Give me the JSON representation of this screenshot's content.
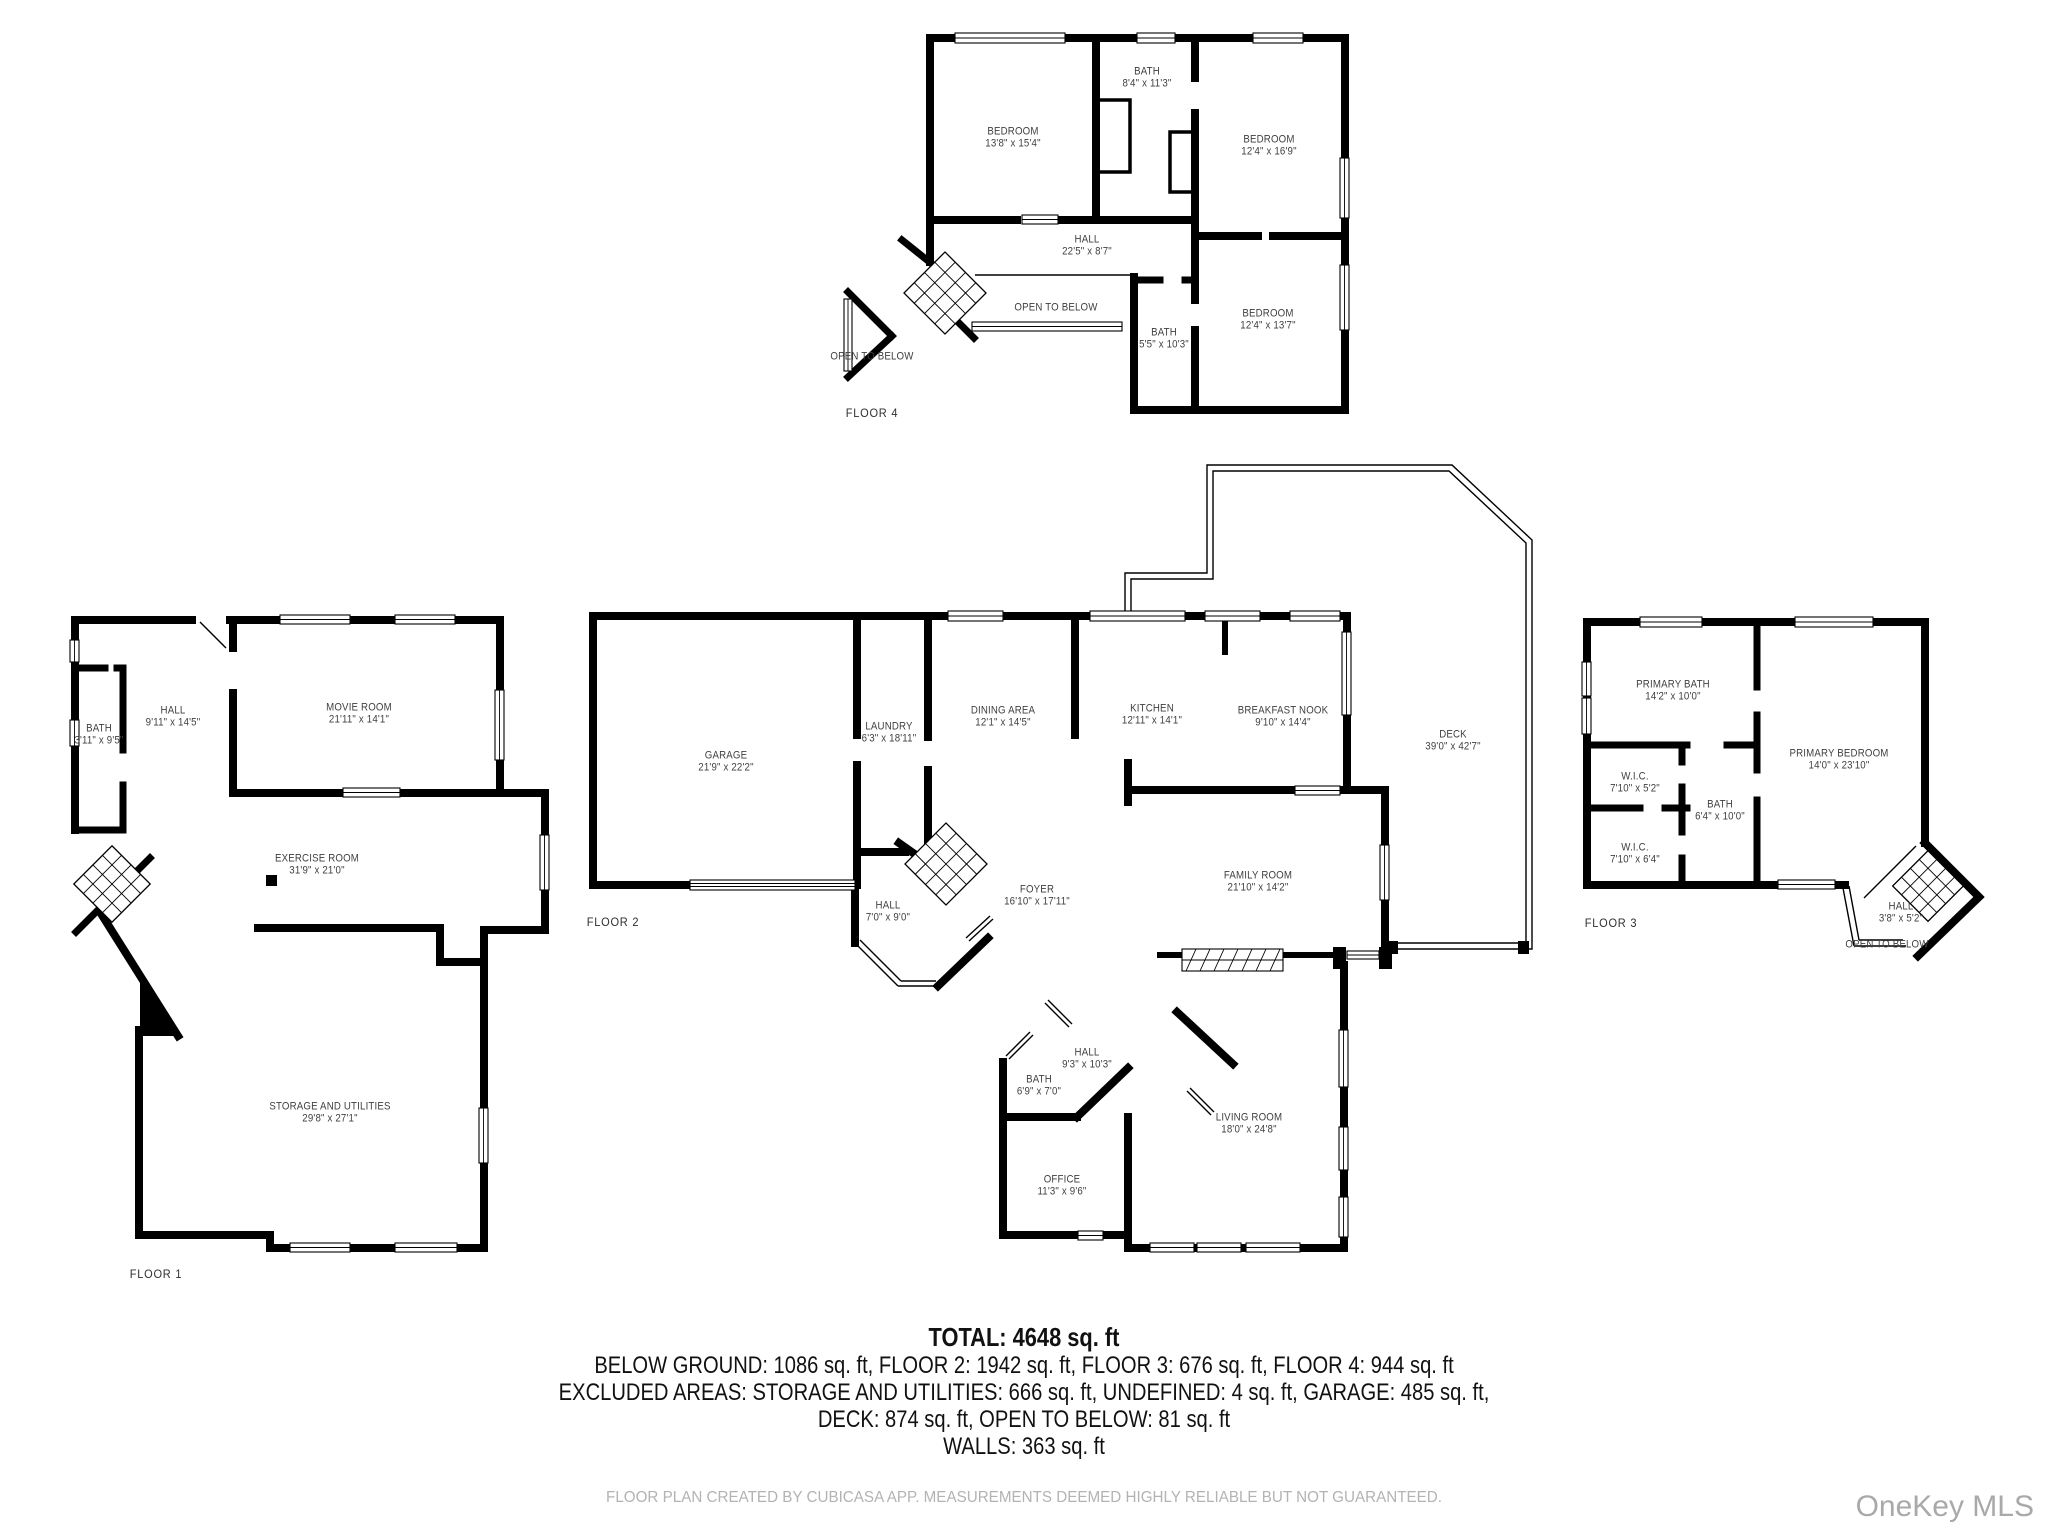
{
  "floors": [
    {
      "caption": "FLOOR 1",
      "rooms": [
        {
          "name": "BATH",
          "dims": "3'11\" x 9'5\""
        },
        {
          "name": "HALL",
          "dims": "9'11\" x 14'5\""
        },
        {
          "name": "MOVIE ROOM",
          "dims": "21'11\" x 14'1\""
        },
        {
          "name": "EXERCISE ROOM",
          "dims": "31'9\" x 21'0\""
        },
        {
          "name": "STORAGE AND UTILITIES",
          "dims": "29'8\" x 27'1\""
        }
      ]
    },
    {
      "caption": "FLOOR 2",
      "rooms": [
        {
          "name": "GARAGE",
          "dims": "21'9\" x 22'2\""
        },
        {
          "name": "LAUNDRY",
          "dims": "6'3\" x 18'11\""
        },
        {
          "name": "DINING AREA",
          "dims": "12'1\" x 14'5\""
        },
        {
          "name": "KITCHEN",
          "dims": "12'11\" x 14'1\""
        },
        {
          "name": "BREAKFAST NOOK",
          "dims": "9'10\" x 14'4\""
        },
        {
          "name": "DECK",
          "dims": "39'0\" x 42'7\""
        },
        {
          "name": "HALL",
          "dims": "7'0\" x 9'0\""
        },
        {
          "name": "FOYER",
          "dims": "16'10\" x 17'11\""
        },
        {
          "name": "FAMILY ROOM",
          "dims": "21'10\" x 14'2\""
        },
        {
          "name": "HALL",
          "dims": "9'3\" x 10'3\""
        },
        {
          "name": "BATH",
          "dims": "6'9\" x 7'0\""
        },
        {
          "name": "LIVING ROOM",
          "dims": "18'0\" x 24'8\""
        },
        {
          "name": "OFFICE",
          "dims": "11'3\" x 9'6\""
        }
      ]
    },
    {
      "caption": "FLOOR 3",
      "rooms": [
        {
          "name": "PRIMARY BATH",
          "dims": "14'2\" x 10'0\""
        },
        {
          "name": "PRIMARY BEDROOM",
          "dims": "14'0\" x 23'10\""
        },
        {
          "name": "W.I.C.",
          "dims": "7'10\" x 5'2\""
        },
        {
          "name": "BATH",
          "dims": "6'4\" x 10'0\""
        },
        {
          "name": "W.I.C.",
          "dims": "7'10\" x 6'4\""
        },
        {
          "name": "HALL",
          "dims": "3'8\" x 5'2\""
        },
        {
          "name": "OPEN TO BELOW",
          "dims": ""
        }
      ]
    },
    {
      "caption": "FLOOR 4",
      "rooms": [
        {
          "name": "BEDROOM",
          "dims": "13'8\" x 15'4\""
        },
        {
          "name": "BATH",
          "dims": "8'4\" x 11'3\""
        },
        {
          "name": "BEDROOM",
          "dims": "12'4\" x 16'9\""
        },
        {
          "name": "HALL",
          "dims": "22'5\" x 8'7\""
        },
        {
          "name": "OPEN TO BELOW",
          "dims": ""
        },
        {
          "name": "BATH",
          "dims": "5'5\" x 10'3\""
        },
        {
          "name": "BEDROOM",
          "dims": "12'4\" x 13'7\""
        },
        {
          "name": "OPEN TO BELOW",
          "dims": ""
        }
      ]
    }
  ],
  "summary": {
    "total": "TOTAL: 4648 sq. ft",
    "line1": "BELOW GROUND: 1086 sq. ft, FLOOR 2: 1942 sq. ft, FLOOR 3: 676 sq. ft, FLOOR 4: 944 sq. ft",
    "line2": "EXCLUDED AREAS: STORAGE AND UTILITIES: 666 sq. ft, UNDEFINED: 4 sq. ft, GARAGE: 485 sq. ft,",
    "line3": "DECK: 874 sq. ft, OPEN TO BELOW: 81 sq. ft",
    "line4": "WALLS: 363 sq. ft"
  },
  "footer": "FLOOR PLAN CREATED BY CUBICASA APP. MEASUREMENTS DEEMED HIGHLY RELIABLE BUT NOT GUARANTEED.",
  "watermark": "OneKey MLS"
}
